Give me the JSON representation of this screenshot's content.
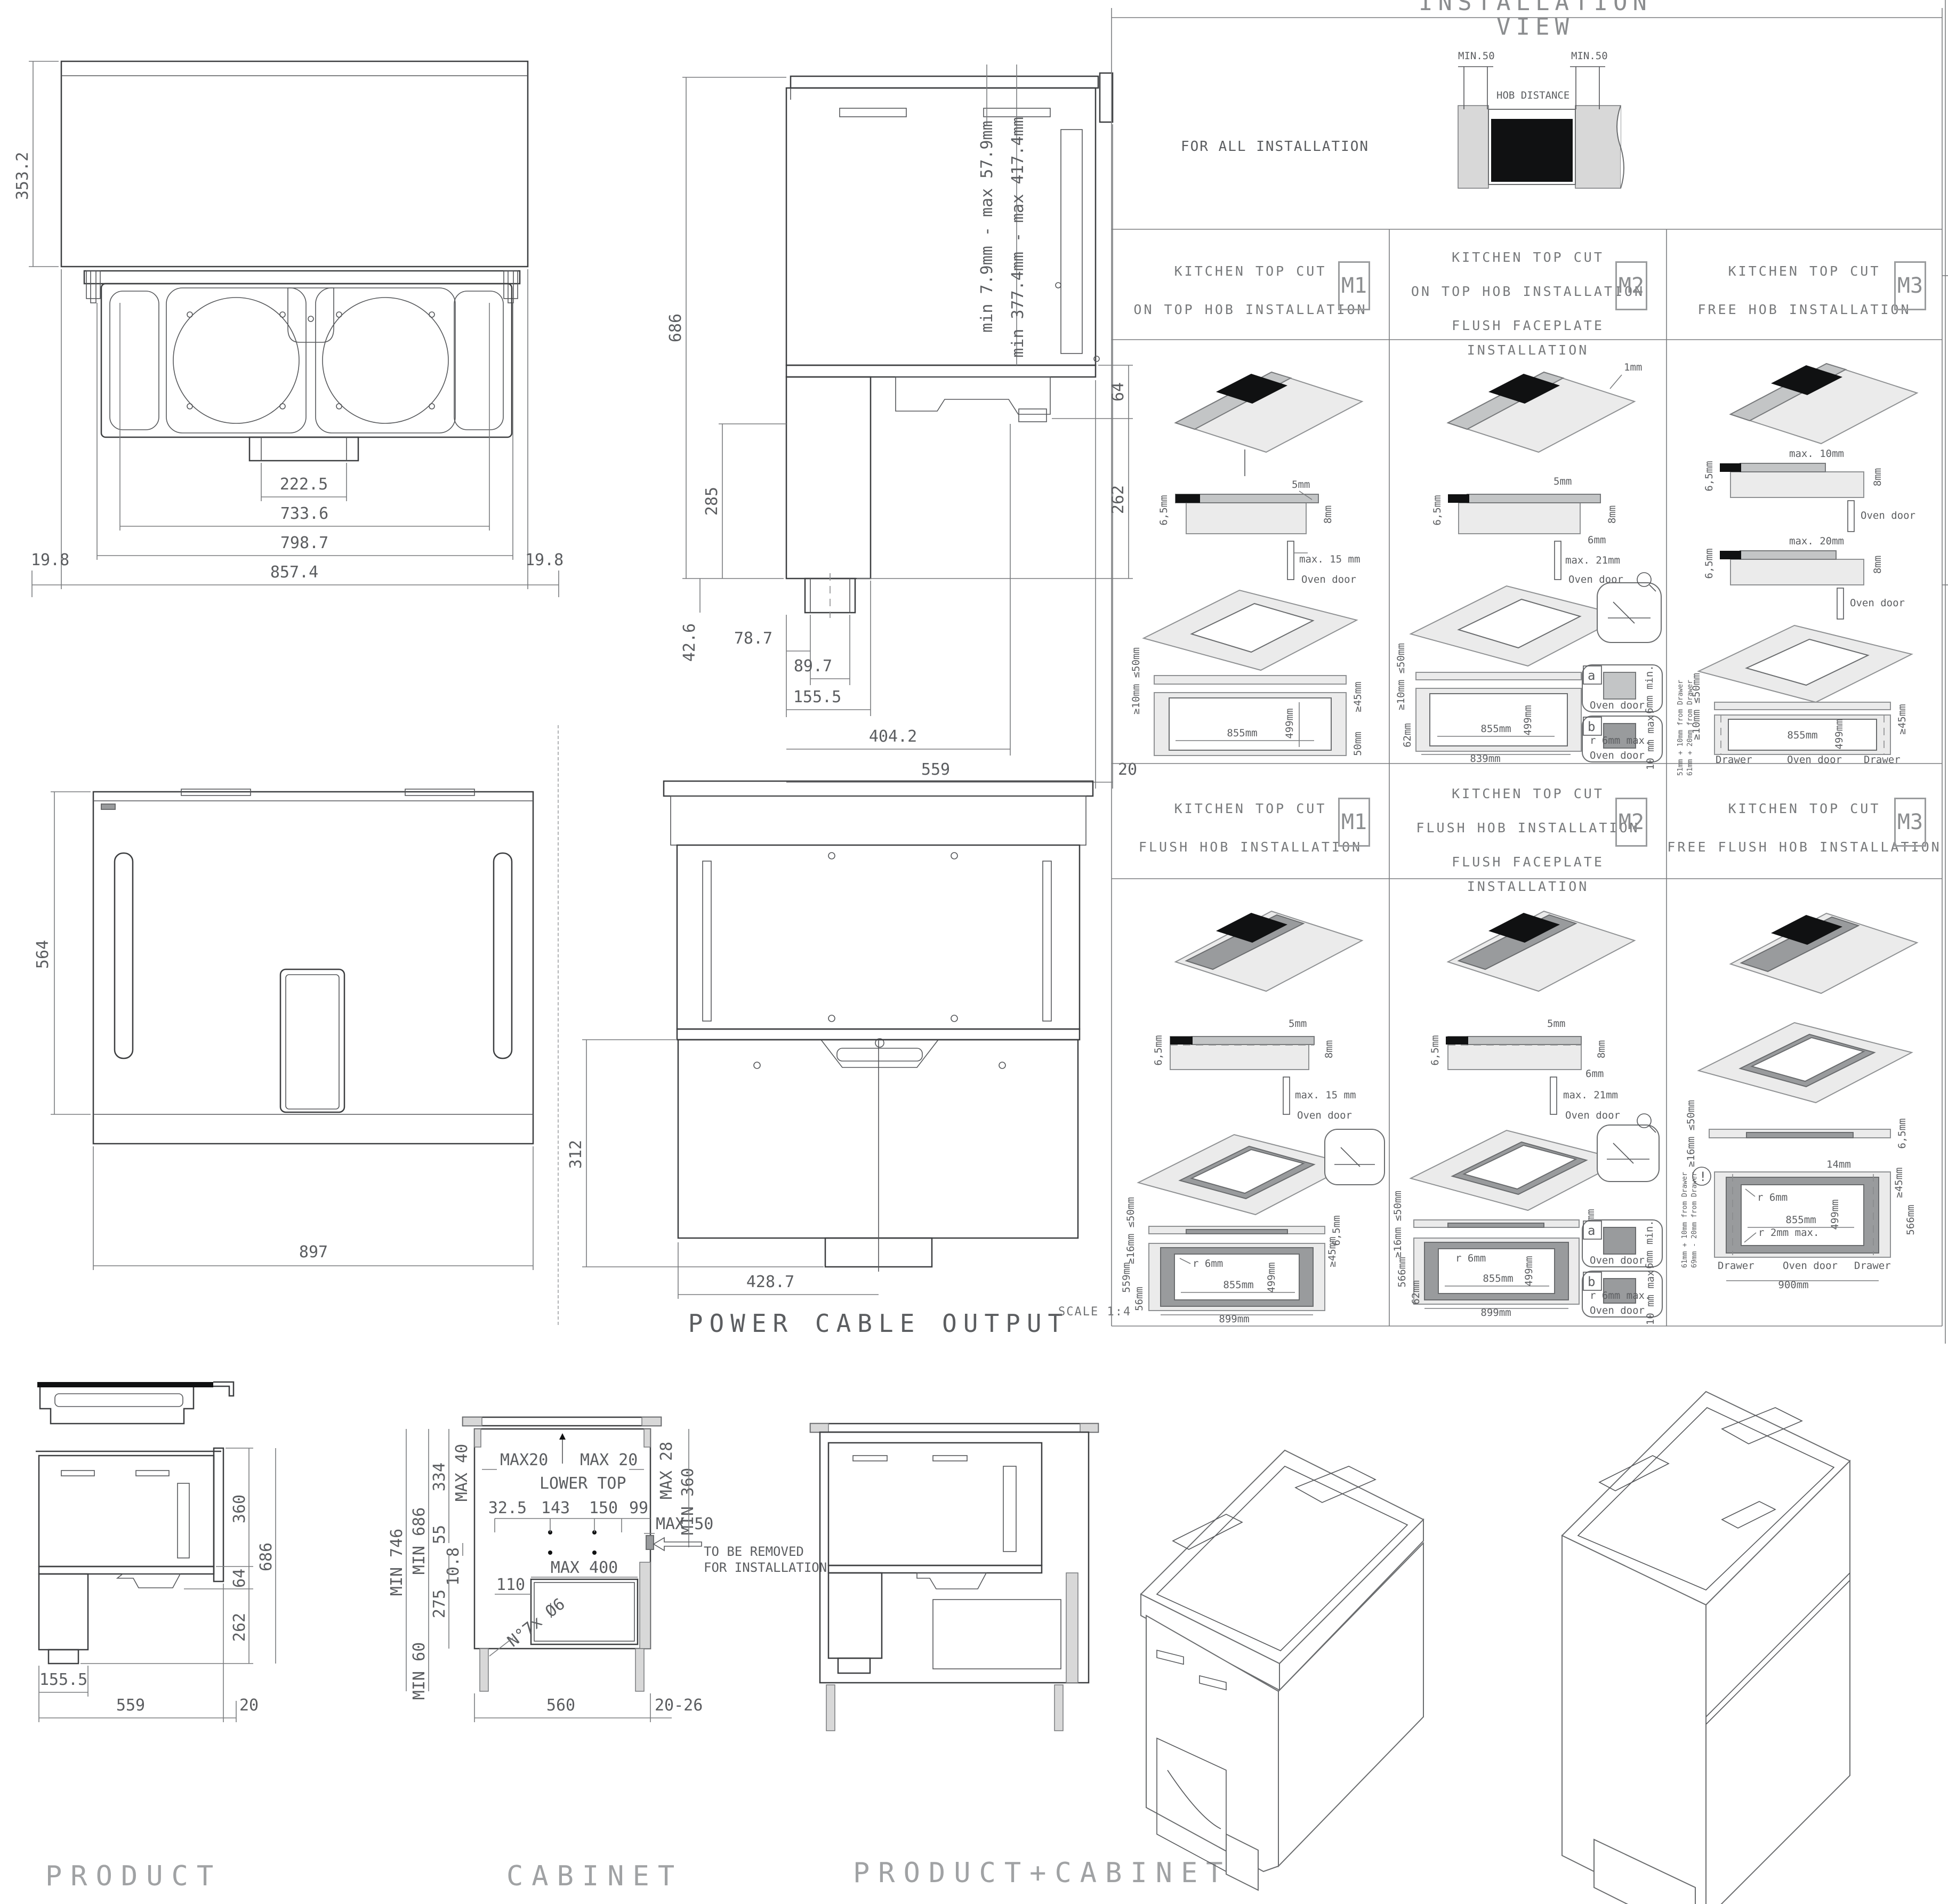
{
  "sheet": {
    "scale_note": "SCALE 1:4"
  },
  "installation": {
    "title": "INSTALLATION VIEW",
    "for_all": "FOR ALL INSTALLATION",
    "min_left": "MIN.50",
    "min_right": "MIN.50",
    "hob_distance": "HOB DISTANCE"
  },
  "rear": {
    "height": "353.2",
    "duct": "222.5",
    "inner": "733.6",
    "mid": "798.7",
    "overall": "857.4",
    "side_left": "19.8",
    "side_right": "19.8"
  },
  "side": {
    "height": "686",
    "chimney": "285",
    "duct_h": "42.6",
    "d1": "78.7",
    "d2": "89.7",
    "d3": "155.5",
    "d4": "404.2",
    "depth": "559",
    "gap": "20",
    "hinge": "64",
    "lower": "262",
    "range1": "min 7.9mm - max 57.9mm",
    "range2": "min 377.4mm - max 417.4mm"
  },
  "topview": {
    "depth": "564",
    "width": "897"
  },
  "power": {
    "title": "POWER CABLE OUTPUT",
    "height": "312",
    "offset": "428.7"
  },
  "product": {
    "title": "PRODUCT",
    "upper": "360",
    "hinge": "64",
    "lower": "262",
    "height": "686",
    "duct": "155.5",
    "depth": "559",
    "gap": "20"
  },
  "cabinet": {
    "title": "CABINET",
    "min746": "MIN 746",
    "min686": "MIN 686",
    "max40": "MAX 40",
    "d334": "334",
    "d55": "55",
    "d108": "10.8",
    "d275": "275",
    "min60": "MIN 60",
    "max20l": "MAX20",
    "lower_top": "LOWER TOP",
    "max20r": "MAX 20",
    "max28": "MAX 28",
    "min360": "MIN 360",
    "max50": "MAX 50",
    "c1": "32.5",
    "c2": "143",
    "c3": "150",
    "c4": "99",
    "d110": "110",
    "max400": "MAX 400",
    "drill": "N°7x Ø6",
    "remove1": "TO BE REMOVED",
    "remove2": "FOR INSTALLATION",
    "w": "560",
    "g": "20-26"
  },
  "pcab": {
    "title": "PRODUCT+CABINET"
  },
  "grid": {
    "r1m1": {
      "h1": "KITCHEN TOP CUT",
      "h2": "ON TOP HOB INSTALLATION",
      "code": "M1",
      "cs_l": "6,5mm",
      "cs_r": "8mm",
      "cs_g": "5mm",
      "cs_d": "max. 15 mm",
      "cs_door": "Oven door",
      "p_t": "≥10mm ≤50mm",
      "p_w": "855mm",
      "p_h": "499mm",
      "p_m": "≥45mm",
      "p_b": "50mm"
    },
    "r1m2": {
      "h1": "KITCHEN TOP CUT",
      "h2": "ON TOP HOB INSTALLATION",
      "h3": "FLUSH FACEPLATE INSTALLATION",
      "code": "M2",
      "iso_n": "1mm",
      "cs_l": "6,5mm",
      "cs_t": "5mm",
      "cs_r": "8mm",
      "cs_b": "6mm",
      "cs_d": "max. 21mm",
      "cs_door": "Oven door",
      "p_t": "≥10mm ≤50mm",
      "p_m": "≥45mm",
      "p_w": "855mm",
      "p_h": "499mm",
      "p_l": "62mm",
      "p_o": "839mm",
      "a": "a",
      "a1": "6mm min.",
      "a2": "Oven door",
      "b": "b",
      "b1": "r 6mm max.",
      "b2": "10 mm max.",
      "b3": "Oven door"
    },
    "r1m3": {
      "h1": "KITCHEN TOP CUT",
      "h2": "FREE HOB INSTALLATION",
      "code": "M3",
      "cs1_l": "6,5mm",
      "cs1_t": "max. 10mm",
      "cs1_r": "8mm",
      "cs1_door": "Oven door",
      "cs2_l": "6,5mm",
      "cs2_t": "max. 20mm",
      "cs2_r": "8mm",
      "cs2_door": "Oven door",
      "p_t": "≥10mm ≤50mm",
      "p_m": "≥45mm",
      "p_w": "855mm",
      "p_h": "499mm",
      "n1": "51mm + 10mm from Drawer",
      "n2": "61mm + 20mm from Drawer",
      "d1": "Drawer",
      "d2": "Oven door",
      "d3": "Drawer"
    },
    "r2m1": {
      "h1": "KITCHEN TOP CUT",
      "h2": "FLUSH HOB INSTALLATION",
      "code": "M1",
      "cs_l": "6,5mm",
      "cs_r": "8mm",
      "cs_g": "5mm",
      "cs_d": "max. 15 mm",
      "cs_door": "Oven door",
      "p_t": "≥16mm ≤50mm",
      "p_r": "6,5mm",
      "rad": "r 6mm",
      "p_m": "≥45mm",
      "p_w": "855mm",
      "p_h": "499mm",
      "p_s": "559mm",
      "p_s2": "56mm",
      "p_o": "899mm"
    },
    "r2m2": {
      "h1": "KITCHEN TOP CUT",
      "h2": "FLUSH HOB INSTALLATION",
      "h3": "FLUSH FACEPLATE INSTALLATION",
      "code": "M2",
      "cs_l": "6,5mm",
      "cs_t": "5mm",
      "cs_r": "8mm",
      "cs_b": "6mm",
      "cs_d": "max. 21mm",
      "cs_door": "Oven door",
      "p_t": "≥16mm ≤50mm",
      "p_r": "6,5mm",
      "rad": "r 6mm",
      "p_m": "≥45mm",
      "p_w": "855mm",
      "p_h": "499mm",
      "p_l": "62mm",
      "p_s": "566mm",
      "p_o": "899mm",
      "a": "a",
      "a1": "6mm min.",
      "a2": "Oven door",
      "b": "b",
      "b1": "r 6mm max.",
      "b2": "10 mm max.",
      "b3": "Oven door"
    },
    "r2m3": {
      "h1": "KITCHEN TOP CUT",
      "h2": "FREE FLUSH HOB INSTALLATION",
      "code": "M3",
      "p_t": "≥16mm ≤50mm",
      "p_r": "6,5mm",
      "rad": "r 6mm",
      "rad2": "r 2mm max.",
      "p_m": "≥45mm",
      "gap": "14mm",
      "p_w": "855mm",
      "p_h": "499mm",
      "p_s": "566mm",
      "p_o": "900mm",
      "warn": "!",
      "n1": "61mm + 10mm from Drawer",
      "n2": "69mm - 20mm from Drawer",
      "d1": "Drawer",
      "d2": "Oven door",
      "d3": "Drawer"
    }
  }
}
